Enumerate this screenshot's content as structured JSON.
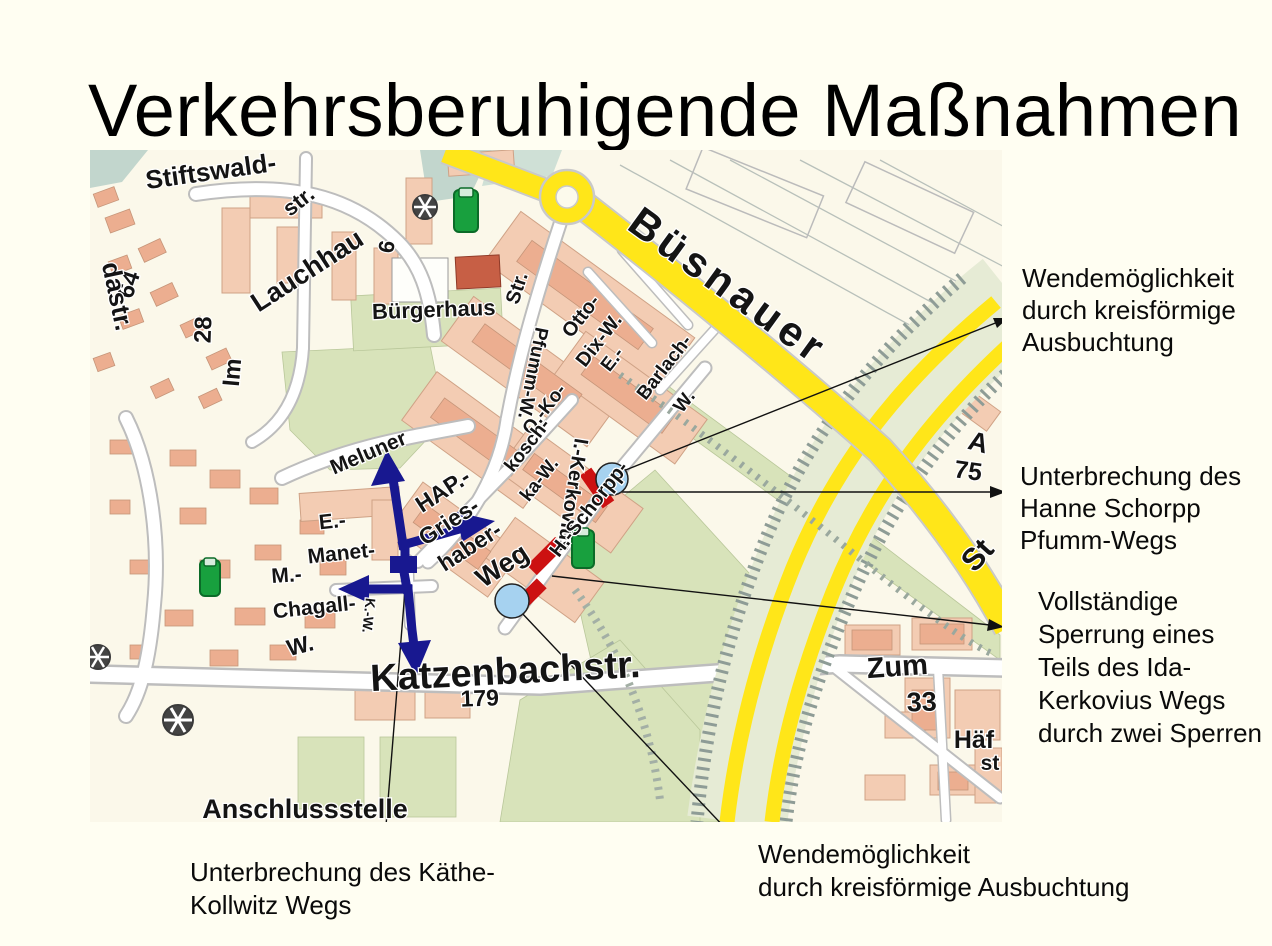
{
  "title": "Verkehrsberuhigende Maßnahmen",
  "annotations": {
    "top_right": {
      "lines": [
        "Wendemöglichkeit",
        "durch kreisförmige",
        "Ausbuchtung"
      ]
    },
    "mid_right": {
      "lines": [
        "Unterbrechung des",
        "Hanne Schorpp",
        "Pfumm-Wegs"
      ]
    },
    "lower_right": {
      "lines": [
        "Vollständige",
        "Sperrung eines",
        "Teils des Ida-",
        "Kerkovius Wegs",
        "durch zwei Sperren"
      ]
    },
    "bottom_left": {
      "lines": [
        "Unterbrechung des Käthe-",
        "Kollwitz Wegs"
      ]
    },
    "bottom_center": {
      "lines": [
        "Wendemöglichkeit",
        "durch kreisförmige Ausbuchtung"
      ]
    }
  },
  "map": {
    "colors": {
      "road_yellow": "#FFE619",
      "barrier_red": "#CC1111",
      "turning_circle_blue": "#A6D2F0",
      "arrow_navy": "#181890",
      "block_salmon": "#F3CCB3",
      "green_area": "#D8E3BA"
    },
    "markers": {
      "red_barriers": 3,
      "turning_circles": 2,
      "blue_arrows": 4,
      "blue_barrier_square": 1
    },
    "labels": [
      {
        "t": "Stiftswald-",
        "x": 212,
        "y": 180,
        "r": -8,
        "s": 26
      },
      {
        "t": "str.",
        "x": 303,
        "y": 207,
        "r": -38,
        "s": 22
      },
      {
        "t": "Lauchhau",
        "x": 312,
        "y": 278,
        "r": -33,
        "s": 27
      },
      {
        "t": "Im",
        "x": 240,
        "y": 373,
        "r": -85,
        "s": 24
      },
      {
        "t": "28",
        "x": 211,
        "y": 330,
        "r": -88,
        "s": 24
      },
      {
        "t": "64",
        "x": 136,
        "y": 287,
        "r": -72,
        "s": 24
      },
      {
        "t": "dastr.",
        "x": 109,
        "y": 298,
        "r": 78,
        "s": 26
      },
      {
        "t": "6",
        "x": 394,
        "y": 248,
        "r": -80,
        "s": 22
      },
      {
        "t": "Bürgerhaus",
        "x": 434,
        "y": 317,
        "r": -2,
        "s": 22
      },
      {
        "t": "Büsnauer",
        "x": 720,
        "y": 297,
        "r": 36,
        "s": 42,
        "ls": 5
      },
      {
        "t": "Str.",
        "x": 523,
        "y": 290,
        "r": -72,
        "s": 20
      },
      {
        "t": "Otto-",
        "x": 586,
        "y": 320,
        "r": -52,
        "s": 20
      },
      {
        "t": "Dix-W.",
        "x": 604,
        "y": 344,
        "r": -52,
        "s": 20
      },
      {
        "t": "Pfumm-W.",
        "x": 527,
        "y": 372,
        "r": 101,
        "s": 19
      },
      {
        "t": "O.-Ko-",
        "x": 549,
        "y": 413,
        "r": -52,
        "s": 19
      },
      {
        "t": "kosch-",
        "x": 532,
        "y": 449,
        "r": -52,
        "s": 19
      },
      {
        "t": "ka-W.",
        "x": 544,
        "y": 483,
        "r": -52,
        "s": 19
      },
      {
        "t": "I.-Kerkovius",
        "x": 566,
        "y": 494,
        "r": 99,
        "s": 20
      },
      {
        "t": "E.-",
        "x": 617,
        "y": 363,
        "r": -52,
        "s": 19
      },
      {
        "t": "Barlach-",
        "x": 669,
        "y": 371,
        "r": -52,
        "s": 19
      },
      {
        "t": "W.",
        "x": 689,
        "y": 405,
        "r": -52,
        "s": 19
      },
      {
        "t": "H.-Schorpp-",
        "x": 594,
        "y": 513,
        "r": -52,
        "s": 20
      },
      {
        "t": "Meluner",
        "x": 371,
        "y": 459,
        "r": -23,
        "s": 21
      },
      {
        "t": "HAP.-",
        "x": 447,
        "y": 497,
        "r": -33,
        "s": 23
      },
      {
        "t": "Gries-",
        "x": 453,
        "y": 528,
        "r": -33,
        "s": 23
      },
      {
        "t": "haber-",
        "x": 474,
        "y": 553,
        "r": -33,
        "s": 23
      },
      {
        "t": "Weg",
        "x": 507,
        "y": 573,
        "r": -33,
        "s": 27
      },
      {
        "t": "E.-",
        "x": 333,
        "y": 528,
        "r": -6,
        "s": 21
      },
      {
        "t": "Manet-",
        "x": 342,
        "y": 560,
        "r": -6,
        "s": 21
      },
      {
        "t": "M.-",
        "x": 287,
        "y": 582,
        "r": -4,
        "s": 21
      },
      {
        "t": "Chagall-",
        "x": 315,
        "y": 614,
        "r": -6,
        "s": 21
      },
      {
        "t": "W.",
        "x": 302,
        "y": 653,
        "r": -14,
        "s": 23
      },
      {
        "t": "K.-W.",
        "x": 364,
        "y": 615,
        "r": 96,
        "s": 14
      },
      {
        "t": "Katzenbachstr.",
        "x": 506,
        "y": 684,
        "r": -3,
        "s": 38
      },
      {
        "t": "179",
        "x": 480,
        "y": 706,
        "r": -2,
        "s": 23
      },
      {
        "t": "Anschlussstelle",
        "x": 305,
        "y": 818,
        "r": 0,
        "s": 27
      },
      {
        "t": "Zum",
        "x": 898,
        "y": 676,
        "r": -4,
        "s": 29
      },
      {
        "t": "33",
        "x": 922,
        "y": 711,
        "r": -2,
        "s": 27
      },
      {
        "t": "Häf",
        "x": 974,
        "y": 748,
        "r": 0,
        "s": 25
      },
      {
        "t": "st",
        "x": 990,
        "y": 770,
        "r": 0,
        "s": 21
      },
      {
        "t": "A",
        "x": 976,
        "y": 451,
        "r": 15,
        "s": 27
      },
      {
        "t": "75",
        "x": 967,
        "y": 479,
        "r": 8,
        "s": 25
      },
      {
        "t": "St",
        "x": 985,
        "y": 562,
        "r": -48,
        "s": 31
      }
    ]
  }
}
